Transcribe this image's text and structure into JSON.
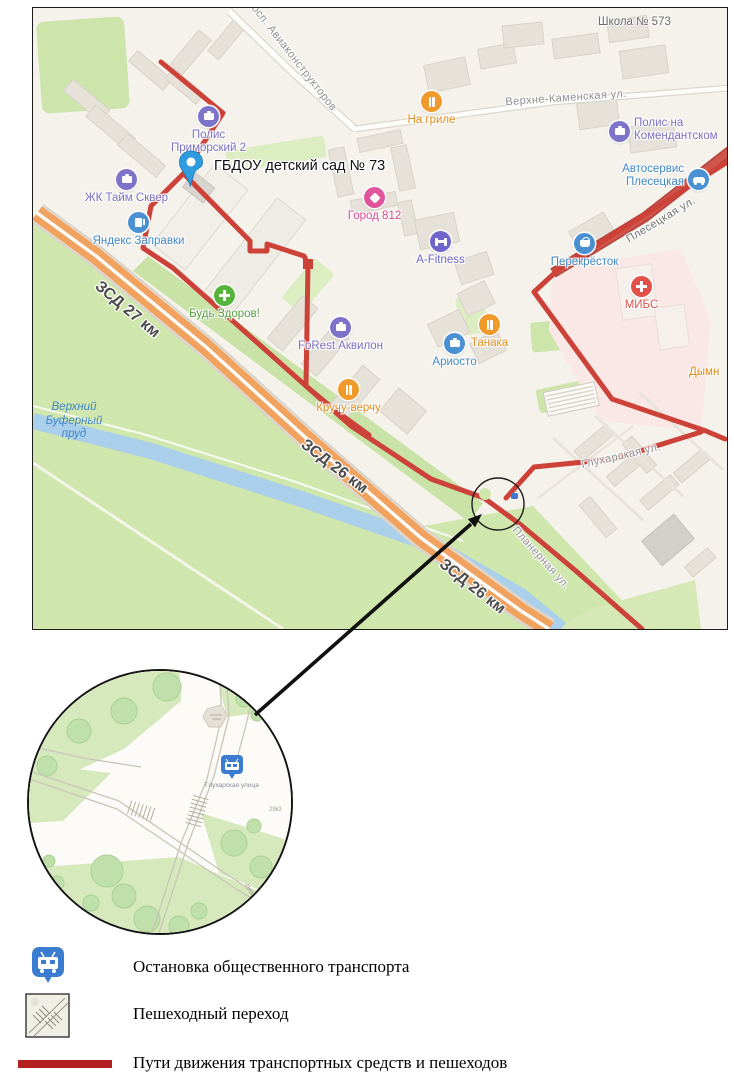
{
  "map": {
    "destination_label": "ГБДОУ детский сад № 73",
    "school_label": "Школа № 573",
    "pois": [
      {
        "id": "polis-primorsky-2",
        "label": "Полис",
        "label2": "Приморский 2"
      },
      {
        "id": "zhk-time-square",
        "label": "ЖК Тайм Сквер"
      },
      {
        "id": "yandex-zapravki",
        "label": "Яндекс Заправки"
      },
      {
        "id": "gorod-812",
        "label": "Город 812"
      },
      {
        "id": "na-grile",
        "label": "На гриле"
      },
      {
        "id": "a-fitness",
        "label": "A-Fitness"
      },
      {
        "id": "forest-akvilon",
        "label": "FoRest Аквилон"
      },
      {
        "id": "tanaka",
        "label": "Танака"
      },
      {
        "id": "ariosto",
        "label": "Ариосто"
      },
      {
        "id": "bud-zdorov",
        "label": "Будь Здоров!"
      },
      {
        "id": "kruchu-verchu",
        "label": "Кручу-верчу"
      },
      {
        "id": "perekrestok",
        "label": "Перекрёсток"
      },
      {
        "id": "mibs",
        "label": "МИБС"
      },
      {
        "id": "polis-komendantsky",
        "label": "Полис на",
        "label2": "Комендантском"
      },
      {
        "id": "autoservice-plesetskaya",
        "label": "Автосервис",
        "label2": "Плесецкая"
      },
      {
        "id": "dymn",
        "label": "Дымн"
      }
    ],
    "streets": [
      "просп. Авиаконструкторов",
      "Верхне-Каменская ул.",
      "Плесецкая ул.",
      "Глухарская ул.",
      "Планерная ул."
    ],
    "highway_labels": [
      "ЗСД 27 км",
      "ЗСД 26 км",
      "ЗСД 26 км"
    ],
    "water_label": [
      "Верхний",
      "Буферный",
      "пруд"
    ]
  },
  "inset": {
    "bus_stop_label": "Глухарская улица",
    "street_label": "Планерная ул.",
    "house_label": "29к3"
  },
  "legend": {
    "items": [
      {
        "icon": "bus-stop-icon",
        "label": "Остановка общественного транспорта"
      },
      {
        "icon": "pedestrian-crossing-icon",
        "label": "Пешеходный переход"
      },
      {
        "icon": "route-line-swatch",
        "label": "Пути движения транспортных средств и пешеходов"
      }
    ]
  },
  "colors": {
    "route": "#cd4238",
    "legend_route": "#b32020",
    "map_road_red": "#d0544a",
    "highway_orange": "#f0a25e",
    "water": "#aacfea",
    "green": "#cfe6ad",
    "poi_purple": "#7d74c9",
    "poi_blue": "#4a90d2",
    "poi_orange": "#f09a2c",
    "poi_pink": "#e0549c",
    "poi_green": "#56b33c",
    "poi_red": "#e25048",
    "bus_icon_blue": "#3b7cd0",
    "pin_blue": "#2f9ce0"
  }
}
